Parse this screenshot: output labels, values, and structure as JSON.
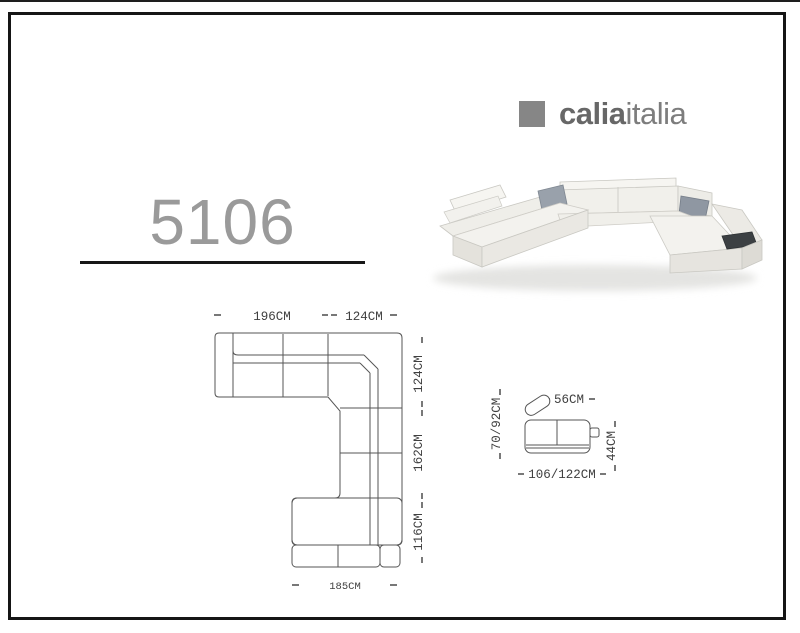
{
  "brand": {
    "name_bold": "calia",
    "name_regular": "italia"
  },
  "model": {
    "number": "5106"
  },
  "plan_view": {
    "dim_top_left": "196CM",
    "dim_top_right": "124CM",
    "dim_right_top": "124CM",
    "dim_right_middle": "162CM",
    "dim_right_bottom": "116CM",
    "dim_bottom": "185CM"
  },
  "side_view": {
    "dim_width": "56CM",
    "dim_height": "70/92CM",
    "dim_depth": "106/122CM",
    "dim_seat_height": "44CM"
  },
  "colors": {
    "brand_gray": "#868686",
    "model_gray": "#9a9a9a",
    "drawing_line_gray": "#555555",
    "pillow_gray": "#929aa5",
    "tray_dark": "#3c4043"
  }
}
